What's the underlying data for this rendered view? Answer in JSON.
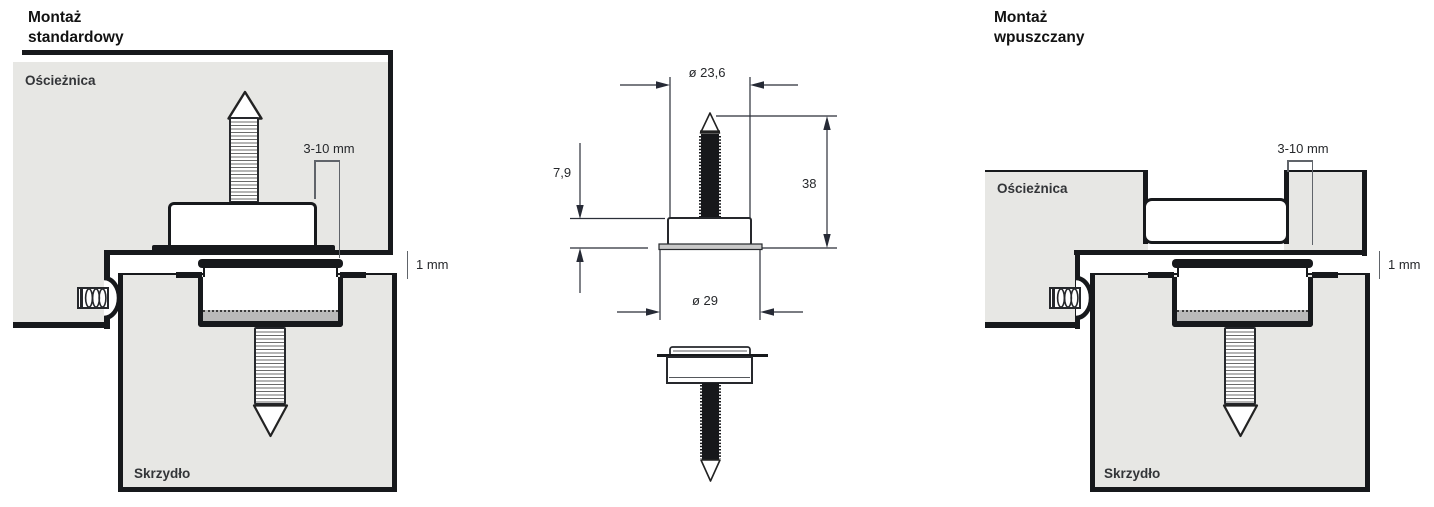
{
  "left_view": {
    "title": "Montaż\nstandardowy",
    "frame_label": "Ościeżnica",
    "leaf_label": "Skrzydło",
    "pin_protrusion_dim": "3-10 mm",
    "gap_dim": "1 mm"
  },
  "center_view": {
    "top_diameter_dim": "ø 23,6",
    "housing_height_dim": "7,9",
    "overall_height_dim": "38",
    "flange_diameter_dim": "ø 29"
  },
  "right_view": {
    "title": "Montaż\nwpuszczany",
    "frame_label": "Ościeżnica",
    "leaf_label": "Skrzydło",
    "pin_protrusion_dim": "3-10 mm",
    "gap_dim": "1 mm"
  },
  "colors": {
    "panel_gray": "#e7e7e4",
    "line_black": "#17191c",
    "cup_band_gray": "#b9b9b9",
    "flange_gray": "#c9c9c9",
    "dim_line_gray": "#60646a",
    "dim_arrow_dark": "#262a35"
  }
}
